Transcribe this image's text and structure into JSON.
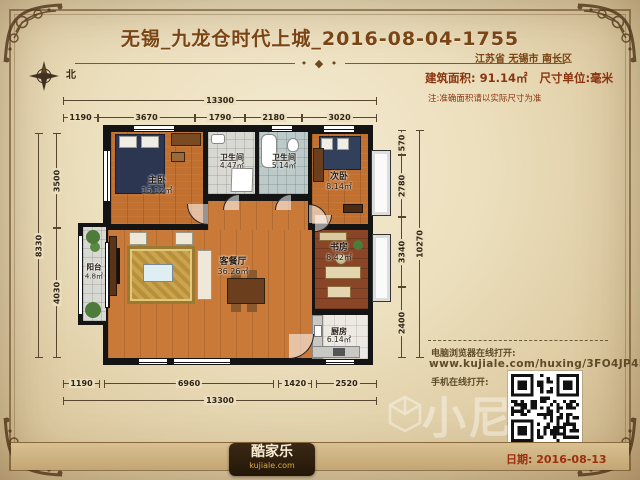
{
  "header": {
    "title": "无锡_九龙仓时代上城_2016-08-04-1755",
    "location": "江苏省 无锡市 南长区"
  },
  "info": {
    "area": "建筑面积: 91.14㎡",
    "unit": "尺寸单位:毫米",
    "note": "注:准确面积请以实际尺寸为准"
  },
  "compass": {
    "north": "北"
  },
  "rooms": {
    "master": {
      "name": "主卧",
      "area": "15.12㎡"
    },
    "bath1": {
      "name": "卫生间",
      "area": "4.47㎡"
    },
    "bath2": {
      "name": "卫生间",
      "area": "5.14㎡"
    },
    "bedroom2": {
      "name": "次卧",
      "area": "8.14㎡"
    },
    "study": {
      "name": "书房",
      "area": "8.42㎡"
    },
    "living": {
      "name": "客餐厅",
      "area": "36.26㎡"
    },
    "balcony": {
      "name": "阳台",
      "area": "4.8㎡"
    },
    "kitchen": {
      "name": "厨房",
      "area": "6.14㎡"
    }
  },
  "dimensions": {
    "top_total": "13300",
    "top_segments": [
      "1190",
      "3670",
      "1790",
      "2180",
      "3020"
    ],
    "bottom_segments": [
      "1190",
      "6960",
      "1420",
      "2520"
    ],
    "bottom_total": "13300",
    "left_segments": [
      "3500",
      "4030"
    ],
    "left_total": "8330",
    "right_segments": [
      "570",
      "2780",
      "3340",
      "2400"
    ],
    "right_total": "10270"
  },
  "share": {
    "pc_label": "电脑浏览器在线打开:",
    "url": "www.kujiale.com/huxing/3FO4JP4E6J7U",
    "mobile_label": "手机在线打开:"
  },
  "footer": {
    "date": "日期: 2016-08-13"
  },
  "logo": {
    "name": "酷家乐",
    "domain": "kujiale.com"
  },
  "watermark": {
    "text": "小尼"
  },
  "colors": {
    "accent": "#8b3410",
    "wall": "#141414",
    "wood": "#c2702f",
    "date_red": "#9c2e0e"
  }
}
